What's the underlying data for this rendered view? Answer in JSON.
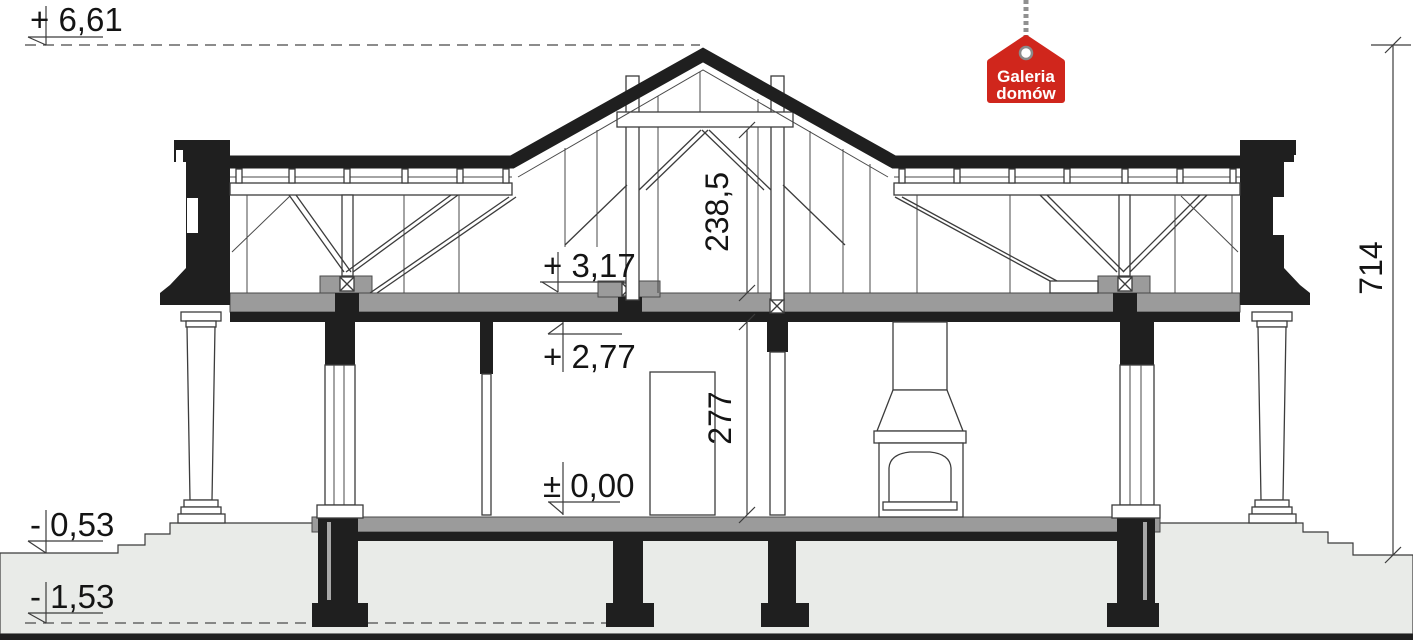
{
  "drawing": {
    "levels": {
      "peak": "+ 6,61",
      "attic_floor": "+ 3,17",
      "ceiling": "+ 2,77",
      "ground_floor": "± 0,00",
      "terrain": "- 0,53",
      "foundation": "- 1,53"
    },
    "dimensions": {
      "attic_height": "238,5",
      "room_height": "277",
      "total_height": "714"
    },
    "logo": {
      "line1": "Galeria",
      "line2": "domów"
    },
    "colors": {
      "ink": "#1f1f1f",
      "slab_gray": "#9b9b9b",
      "terrain_gray": "#e9ebe8",
      "logo_red": "#d0261c"
    }
  }
}
